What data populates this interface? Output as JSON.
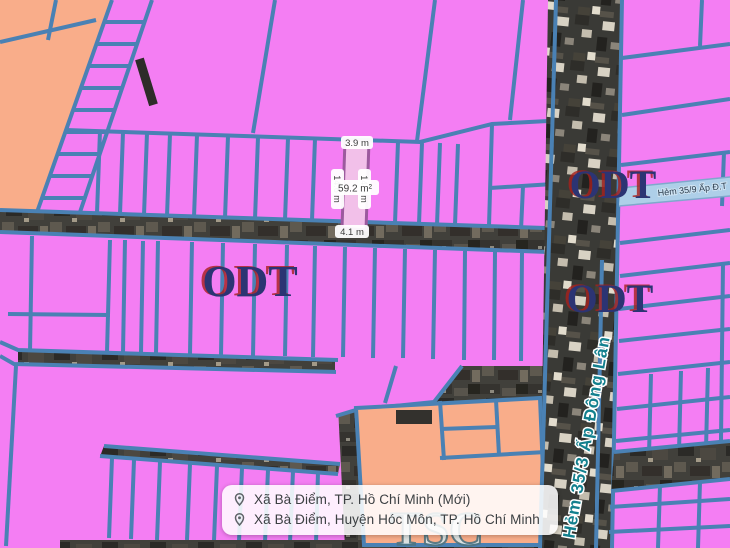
{
  "map": {
    "zones": {
      "odt": "ODT",
      "tsc": "TSC"
    },
    "roads": {
      "main": "Hẻm 35/3 Ấp Đông Lân",
      "side": "Hẻm 35/9 Ấp Đ.T"
    },
    "selected_parcel": {
      "area": "59.2 m²",
      "width_top": "3.9 m",
      "width_bottom": "4.1 m",
      "length_left": "14.6 m",
      "length_right": "14.9 m"
    },
    "colors": {
      "residential_pink": "#f47ef3",
      "mixed_orange": "#f9ad8a",
      "parcel_line_blue": "#4a81b4",
      "zone_label_blue": "#2c3473",
      "zone_label_red_shadow": "#a8201c",
      "road_label_teal": "#13808e",
      "selected_fill": "#f2c0e9",
      "selected_stroke": "#9c5a9e"
    }
  },
  "location_panel": {
    "rows": [
      {
        "icon": "location-pin-icon",
        "label": "Xã Bà Điểm, TP. Hồ Chí Minh (Mới)"
      },
      {
        "icon": "location-pin-icon",
        "label": "Xã Bà Điểm, Huyện Hóc Môn, TP. Hồ Chí Minh"
      }
    ]
  }
}
